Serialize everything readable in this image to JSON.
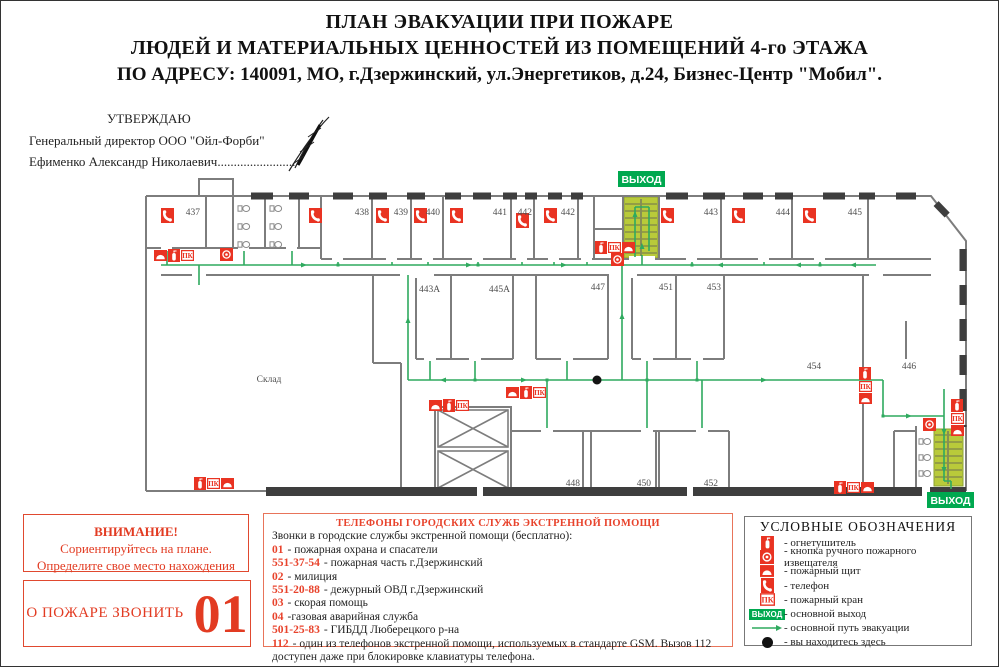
{
  "exit_label": "ВЫХОД",
  "pk_label": "ПК",
  "title": {
    "line1": "ПЛАН ЭВАКУАЦИИ ПРИ ПОЖАРЕ",
    "line2": "ЛЮДЕЙ И МАТЕРИАЛЬНЫХ ЦЕННОСТЕЙ ИЗ ПОМЕЩЕНИЙ 4-го  ЭТАЖА",
    "line3": "ПО АДРЕСУ: 140091,  МО,  г.Дзержинский,  ул.Энергетиков,  д.24,  Бизнес-Центр  \"Мобил\"."
  },
  "approval": {
    "line1": "УТВЕРЖДАЮ",
    "line2": "Генеральный директор   ООО \"Ойл-Форби\"",
    "line3": "Ефименко  Александр  Николаевич........................"
  },
  "plan": {
    "sklad_label": "Склад",
    "rooms": [
      {
        "label": "437"
      },
      {
        "label": "438"
      },
      {
        "label": "439"
      },
      {
        "label": "440"
      },
      {
        "label": "441"
      },
      {
        "label": "442"
      },
      {
        "label": "442"
      },
      {
        "label": "443"
      },
      {
        "label": "444"
      },
      {
        "label": "445"
      },
      {
        "label": "443А"
      },
      {
        "label": "445А"
      },
      {
        "label": "447"
      },
      {
        "label": "451"
      },
      {
        "label": "453"
      },
      {
        "label": "454"
      },
      {
        "label": "446"
      },
      {
        "label": "448"
      },
      {
        "label": "450"
      },
      {
        "label": "452"
      }
    ]
  },
  "attention": {
    "title": "ВНИМАНИЕ!",
    "line1": "Сориентируйтесь на плане.",
    "line2": "Определите свое место  нахождения"
  },
  "fire_call": {
    "label": "О ПОЖАРЕ ЗВОНИТЬ",
    "number": "01"
  },
  "phones": {
    "title": "ТЕЛЕФОНЫ ГОРОДСКИХ СЛУЖБ ЭКСТРЕННОЙ ПОМОЩИ",
    "intro": "Звонки в городские службы экстренной помощи (бесплатно):",
    "items": [
      {
        "num": "01",
        "text": "- пожарная охрана и спасатели"
      },
      {
        "num": "551-37-54",
        "text": "-  пожарная часть г.Дзержинский"
      },
      {
        "num": "02",
        "text": "- милиция"
      },
      {
        "num": "551-20-88",
        "text": "-  дежурный ОВД г.Дзержинский"
      },
      {
        "num": "03",
        "text": "- скорая помощь"
      },
      {
        "num": "04",
        "text": "-газовая аварийная служба"
      },
      {
        "num": "501-25-83",
        "text": "-  ГИБДД Люберецкого  р-на"
      },
      {
        "num": "112",
        "text": "- один из телефонов экстренной помощи,  используемых в стандарте GSM.  Вызов 112 доступен даже при блокировке клавиатуры телефона."
      }
    ]
  },
  "legend": {
    "title": "УСЛОВНЫЕ ОБОЗНАЧЕНИЯ",
    "items": [
      {
        "icon": "fire-extinguisher",
        "label": "- огнетушитель"
      },
      {
        "icon": "manual-call-point",
        "label": "- кнопка ручного пожарного извещателя"
      },
      {
        "icon": "fire-shield",
        "label": "- пожарный щит"
      },
      {
        "icon": "telephone",
        "label": "- телефон"
      },
      {
        "icon": "fire-hydrant-pk",
        "label": "- пожарный кран"
      },
      {
        "icon": "main-exit",
        "label": "- основной выход"
      },
      {
        "icon": "evacuation-route",
        "label": "- основной путь эвакуации"
      },
      {
        "icon": "you-are-here",
        "label": "- вы находитесь здесь"
      }
    ]
  },
  "colors": {
    "accent_red": "#e8432c",
    "icon_red": "#e93322",
    "exit_green": "#00a84f",
    "route_green": "#2faa5f",
    "stair_fill": "#b9ca3a"
  }
}
